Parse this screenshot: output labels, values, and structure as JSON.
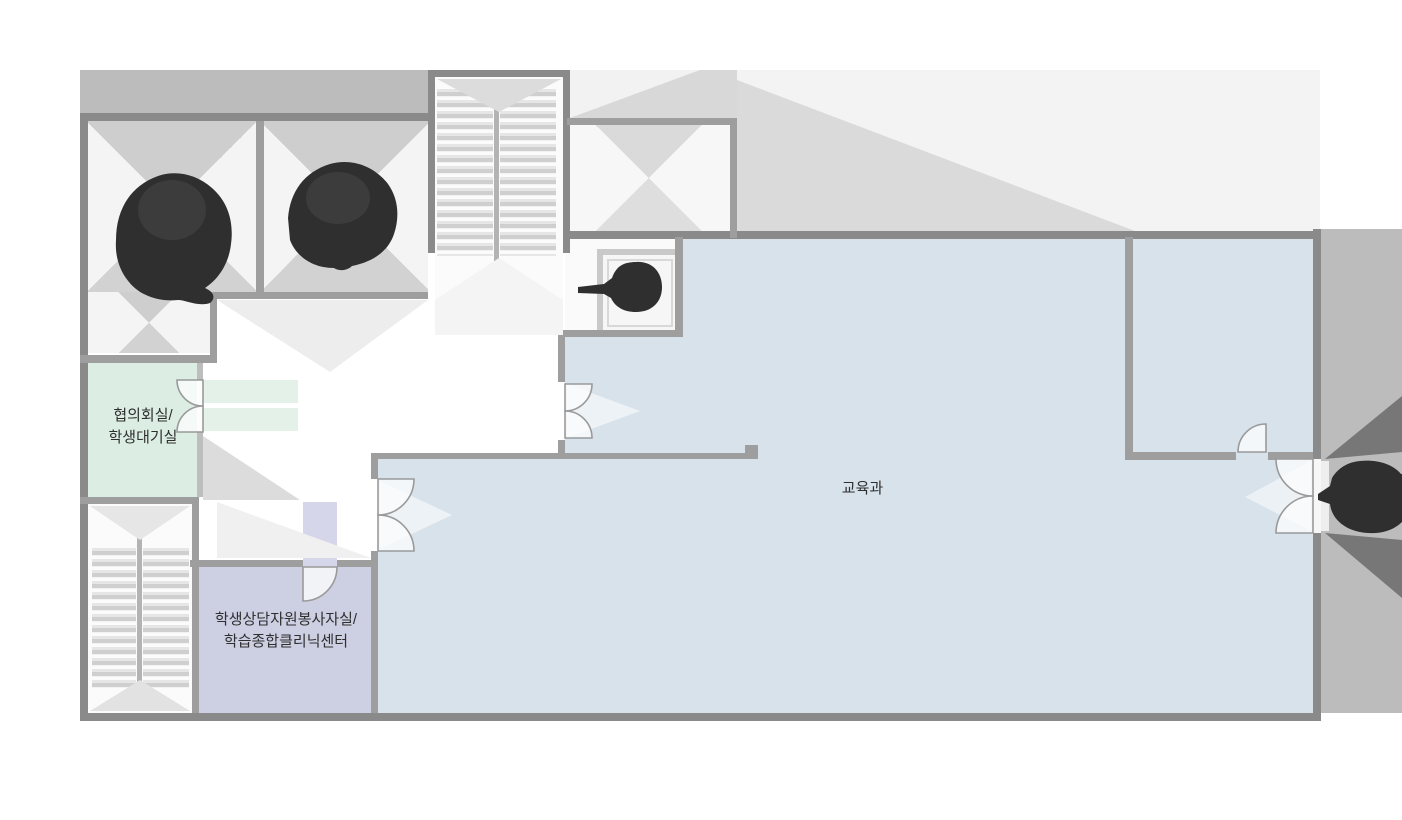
{
  "floorplan": {
    "rooms": {
      "council": {
        "line1": "협의회실/",
        "line2": "학생대기실",
        "color": "#dceee4"
      },
      "counseling": {
        "line1": "학생상담자원봉사자실/",
        "line2": "학습종합클리닉센터",
        "color": "#cdcfe3"
      },
      "education": {
        "label": "교육과",
        "color": "#d7e2eb"
      }
    },
    "palette": {
      "wall_outer": "#8a8a8a",
      "wall_inner": "#9e9e9e",
      "exterior_band": "#bcbcbc",
      "exterior_right": "#bcbcbc",
      "tree": "#2f2f2f",
      "entrance_chevron": "#777777",
      "lightwell_shade": "#d2d2d2"
    }
  }
}
